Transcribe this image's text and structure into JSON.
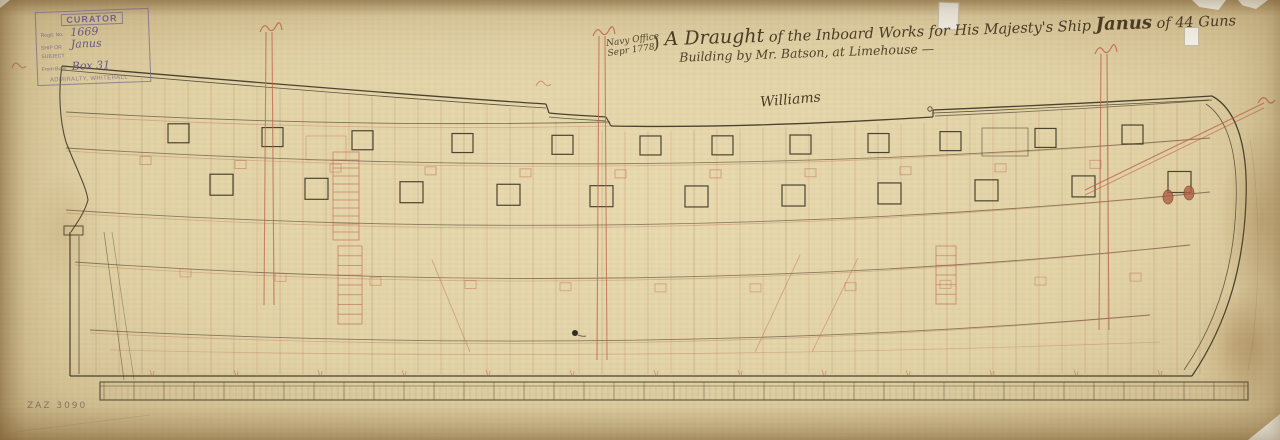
{
  "document": {
    "archive_stamp": {
      "header": "CURATOR",
      "fields": [
        {
          "label": "Regd. No.",
          "value": "1669"
        },
        {
          "label": "SHIP OR SUBJECT",
          "value": "Janus"
        },
        {
          "label": "From Book",
          "value": "Box 31"
        }
      ],
      "footer": "ADMIRALTY, WHITEHALL"
    },
    "title_block": {
      "office": "Navy Office",
      "date": "Sepr 1778",
      "brace": ")",
      "line1_lead": "A Draught",
      "line1_mid": " of the Inboard Works for His Majesty's Ship ",
      "ship_name": "Janus",
      "line1_tail": " of 44 Guns",
      "line2": "Building by Mr. Batson, at Limehouse —"
    },
    "signature": "Williams",
    "catalogue_number": "ZAZ 3090"
  },
  "drawing": {
    "ink_color": "#3a3322",
    "red_ink_color": "#c0634a",
    "paper_color": "#e3d4a8",
    "subject": "inboard-profile-of-44-gun-ship",
    "upper_gunports_x": [
      168,
      262,
      352,
      452,
      552,
      640,
      712,
      790,
      868,
      940,
      1035,
      1122
    ],
    "lower_gunports_x": [
      210,
      305,
      400,
      497,
      590,
      685,
      782,
      878,
      975,
      1072,
      1168
    ],
    "masts": [
      {
        "name": "mizzen-mast",
        "x": 269,
        "top": 32,
        "bottom": 305
      },
      {
        "name": "main-mast",
        "x": 602,
        "top": 36,
        "bottom": 360
      },
      {
        "name": "fore-mast",
        "x": 1104,
        "top": 54,
        "bottom": 330
      }
    ],
    "bowsprit": {
      "x1": 1085,
      "y1": 190,
      "x2": 1264,
      "y2": 103
    },
    "hawse_holes": [
      [
        1168,
        197
      ],
      [
        1189,
        193
      ]
    ],
    "ladders": [
      {
        "x": 333,
        "y": 152,
        "w": 26,
        "h": 88,
        "rungs": 11
      },
      {
        "x": 338,
        "y": 246,
        "w": 24,
        "h": 78,
        "rungs": 8
      },
      {
        "x": 936,
        "y": 246,
        "w": 20,
        "h": 58,
        "rungs": 6
      }
    ],
    "keel_bar": {
      "x1": 100,
      "x2": 1248,
      "y1": 382,
      "y2": 400
    }
  }
}
